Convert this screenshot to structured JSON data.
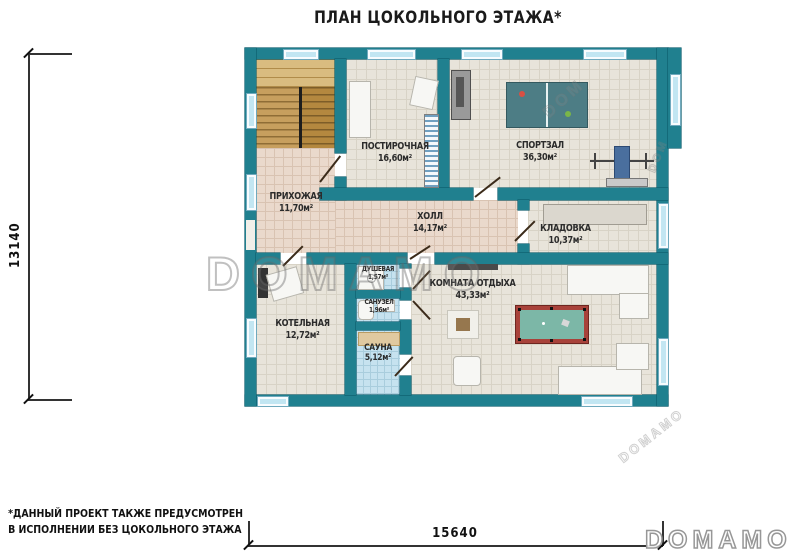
{
  "title": "ПЛАН ЦОКОЛЬНОГО ЭТАЖА*",
  "plan": {
    "rooms": [
      {
        "id": "laundry",
        "name": "ПОСТИРОЧНАЯ",
        "area": "16,60м²"
      },
      {
        "id": "gym",
        "name": "СПОРТЗАЛ",
        "area": "36,30м²"
      },
      {
        "id": "hallway",
        "name": "ПРИХОЖАЯ",
        "area": "11,70м²"
      },
      {
        "id": "hall",
        "name": "ХОЛЛ",
        "area": "14,17м²"
      },
      {
        "id": "storage",
        "name": "КЛАДОВКА",
        "area": "10,37м²"
      },
      {
        "id": "shower",
        "name": "ДУШЕВАЯ",
        "area": "1,57м²"
      },
      {
        "id": "wc",
        "name": "САНУЗЕЛ",
        "area": "1,96м²"
      },
      {
        "id": "boiler",
        "name": "КОТЕЛЬНАЯ",
        "area": "12,72м²"
      },
      {
        "id": "sauna",
        "name": "САУНА",
        "area": "5,12м²"
      },
      {
        "id": "lounge",
        "name": "КОМНАТА ОТДЫХА",
        "area": "43,33м²"
      }
    ]
  },
  "dimensions": {
    "height": "13140",
    "width": "15640"
  },
  "footnote": {
    "line1": "*ДАННЫЙ ПРОЕКТ ТАКЖЕ ПРЕДУСМОТРЕН",
    "line2": "В ИСПОЛНЕНИИ БЕЗ ЦОКОЛЬНОГО ЭТАЖА"
  },
  "logo": "DOMAMO",
  "watermarks": {
    "main": "DOMAMO",
    "small1": "DOM",
    "small2": "DOM",
    "small3": "DOMAMO"
  },
  "colors": {
    "wall": "#20808F",
    "window": "#C2E6F2",
    "floor_tile": "#E8E4DA",
    "floor_warm": "#EAD9CC",
    "wood": "#C79F5E",
    "wet_tile": "#C6E2EF",
    "billiard_frame": "#A8423A",
    "billiard_felt": "#7CB7A7",
    "pingpong": "#4D7D85"
  }
}
